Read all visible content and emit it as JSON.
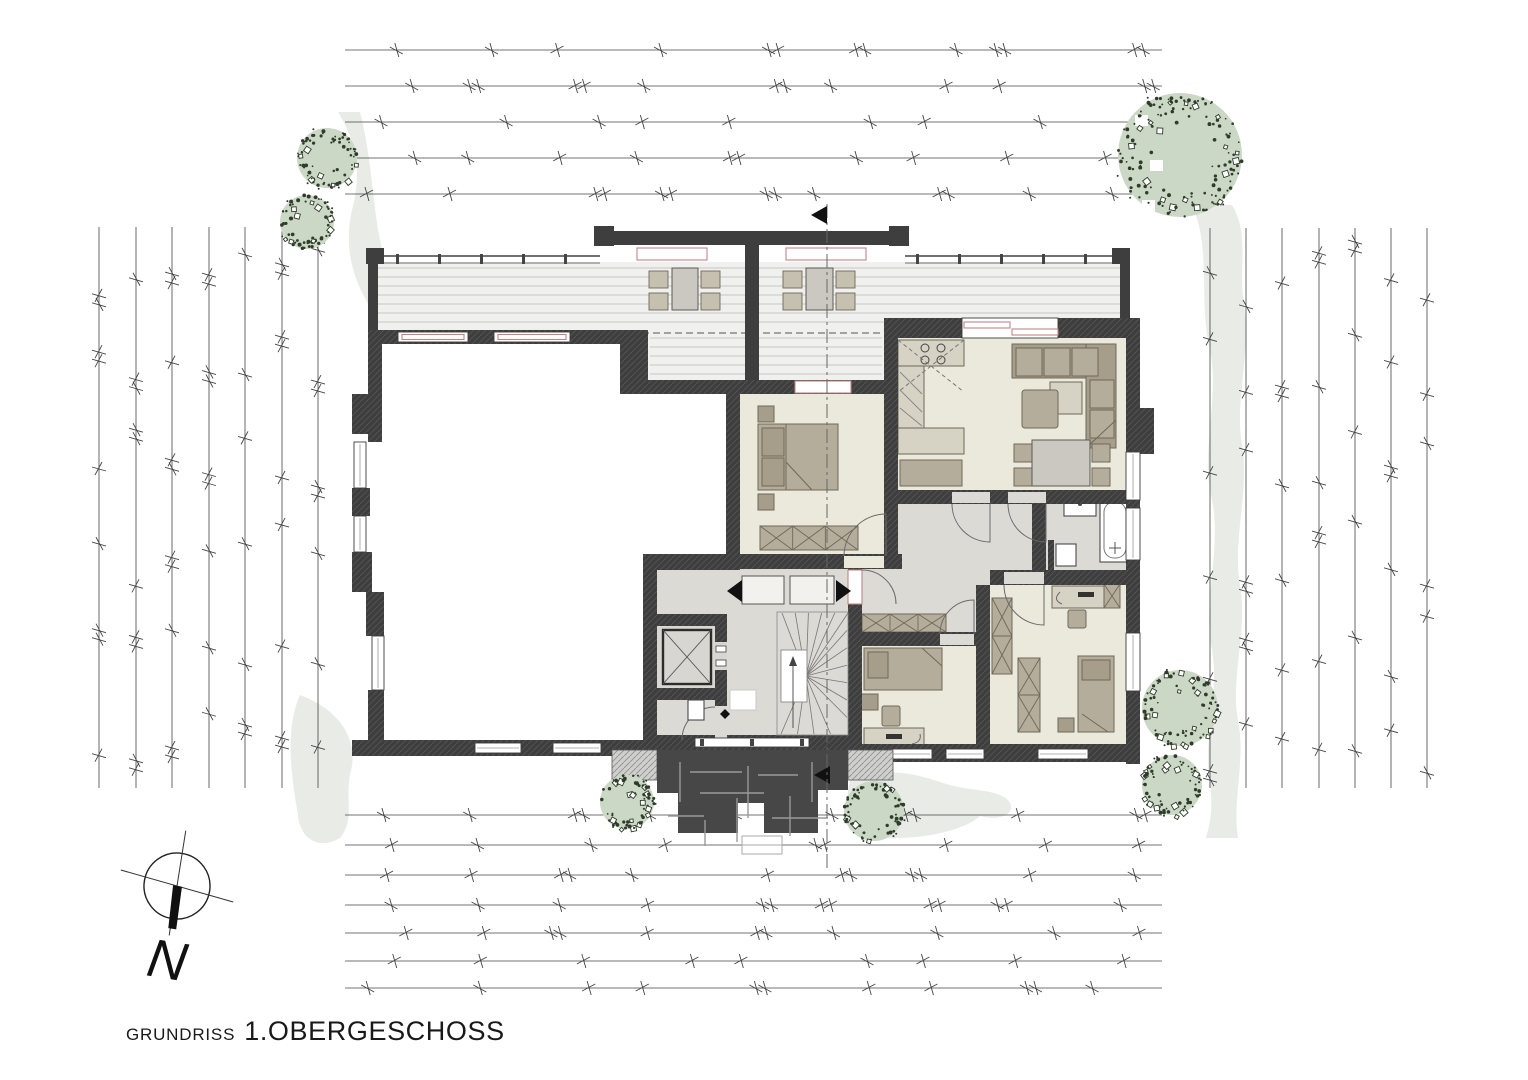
{
  "title": {
    "prefix": "GRUNDRISS",
    "name": "1.OBERGESCHOSS"
  },
  "compass": {
    "north_label": "N"
  },
  "colors": {
    "wall": "#3e3e3e",
    "room_beige": "#ebe9dc",
    "corridor_gray": "#dcdad4",
    "deck": "#f0f0ee",
    "deck_stripe": "#c6c6c4",
    "furniture": "#b5ad9c",
    "furniture_dark": "#a69d8b",
    "furniture_light": "#d6d2c4",
    "furniture_stroke": "#6f6959",
    "tree": "#ccd8c6",
    "tree_speckle": "#2f3c2b",
    "ground_path": "#e9ebe7",
    "canopy": "#474747",
    "glazing": "#c08585",
    "field_line": "#454545",
    "ink": "#191919"
  }
}
